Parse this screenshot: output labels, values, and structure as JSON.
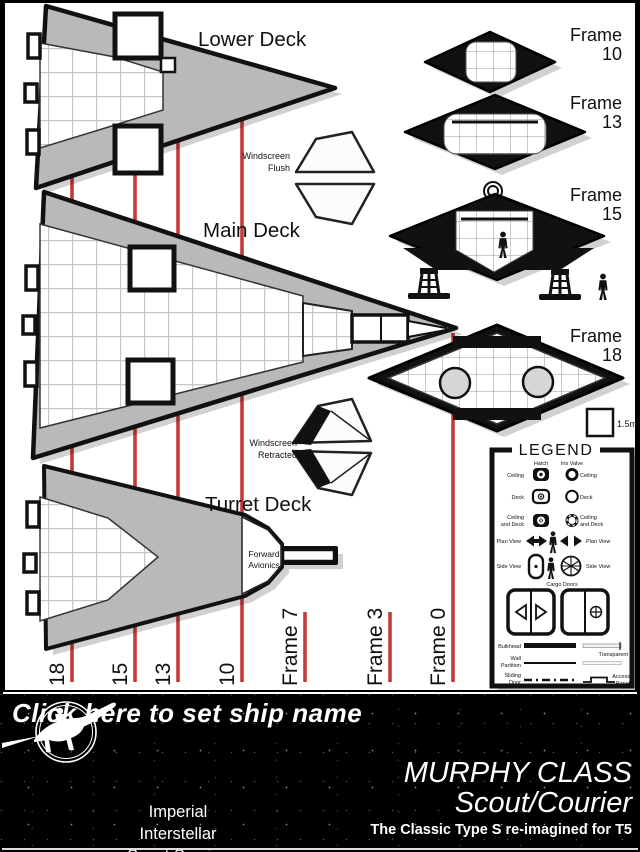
{
  "colors": {
    "frame_line": "#c43a3a",
    "hull": "#b9b9b9",
    "ink": "#111111",
    "paper": "#ffffff"
  },
  "deck_labels": {
    "lower": "Lower Deck",
    "main": "Main Deck",
    "turret": "Turret Deck"
  },
  "annotations": {
    "windscreen_flush": [
      "Windscreen",
      "Flush"
    ],
    "windscreen_retracted": [
      "Windscreen",
      "Retracted"
    ],
    "forward_avionics": [
      "Forward",
      "Avionics"
    ],
    "scale": "1.5m"
  },
  "cross_sections": [
    {
      "label": "Frame",
      "number": "10"
    },
    {
      "label": "Frame",
      "number": "13"
    },
    {
      "label": "Frame",
      "number": "15"
    },
    {
      "label": "Frame",
      "number": "18"
    }
  ],
  "station_lines": [
    "18",
    "15",
    "13",
    "10",
    "Frame 7",
    "Frame 3",
    "Frame 0"
  ],
  "legend": {
    "title": "LEGEND",
    "hatch_header": "Hatch",
    "iris_header": "Iris Valve",
    "ceiling": "Ceiling",
    "deck": "Deck",
    "ceiling_and_deck_1": "Ceiling",
    "ceiling_and_deck_2": "and Deck",
    "plan_view": "Plan View",
    "side_view": "Side View",
    "cargo_doors": "Cargo Doors",
    "bulkhead": "Bulkhead",
    "transparent": "Transparent",
    "wall_1": "Wall",
    "wall_2": "Partition",
    "sliding_1": "Sliding",
    "sliding_2": "Door",
    "access_1": "Access",
    "access_2": "Panel"
  },
  "footer": {
    "ship_name_prompt": "Click here to set ship name",
    "org_line1": "Imperial Interstellar",
    "org_line2": "Scout Service",
    "class_name": "MURPHY CLASS",
    "class_type": "Scout/Courier",
    "tagline": "The Classic Type S re-imagined for T5"
  }
}
